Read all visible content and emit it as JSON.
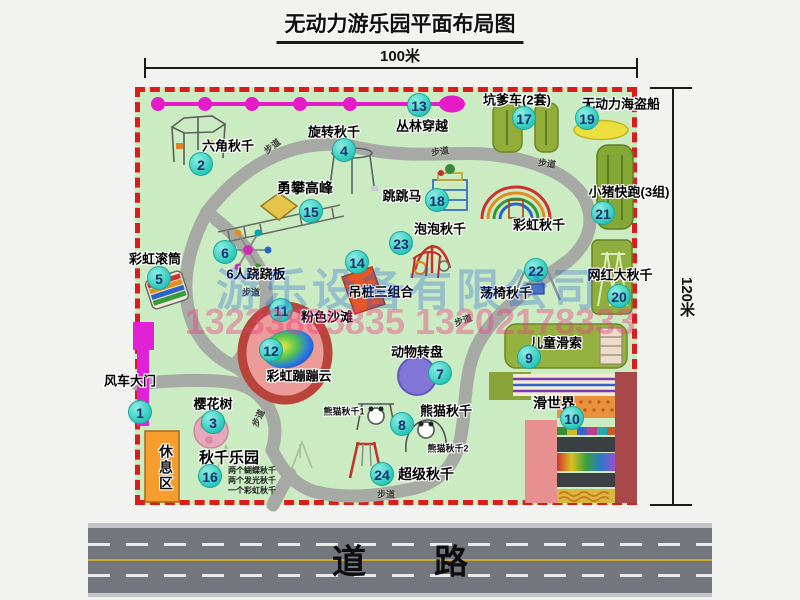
{
  "page": {
    "title": "无动力游乐园平面布局图",
    "top_dim": "100米",
    "right_dim": "120米"
  },
  "road": {
    "label": "道　　路"
  },
  "watermarks": {
    "company": "游乐设备有限公司",
    "phone": "13233805835 13202178333"
  },
  "colors": {
    "map_green": "#cbecc3",
    "border_red": "#dc1c1c",
    "badge_teal": "#2cc8bb",
    "zipline_magenta": "#e51ac8",
    "road_gray": "#73767d",
    "gate_magenta": "#e021d6",
    "rest_orange": "#f59d2e"
  },
  "map": {
    "rest_area_label": "休息区",
    "walkway_label": "步道",
    "walkways": [
      {
        "x": 272,
        "y": 146,
        "r": -38
      },
      {
        "x": 440,
        "y": 151,
        "r": -8
      },
      {
        "x": 547,
        "y": 163,
        "r": 8
      },
      {
        "x": 251,
        "y": 292,
        "r": 0
      },
      {
        "x": 258,
        "y": 418,
        "r": -65
      },
      {
        "x": 386,
        "y": 494,
        "r": 0
      },
      {
        "x": 463,
        "y": 320,
        "r": -20
      }
    ],
    "attractions": [
      {
        "num": 1,
        "label": "风车大门",
        "badge": [
          140,
          412
        ],
        "label_pos": [
          130,
          380
        ]
      },
      {
        "num": 2,
        "label": "六角秋千",
        "badge": [
          201,
          164
        ],
        "label_pos": [
          228,
          145
        ]
      },
      {
        "num": 3,
        "label": "樱花树",
        "badge": [
          213,
          422
        ],
        "label_pos": [
          213,
          403
        ]
      },
      {
        "num": 4,
        "label": "旋转秋千",
        "badge": [
          344,
          150
        ],
        "label_pos": [
          334,
          131
        ]
      },
      {
        "num": 5,
        "label": "彩虹滚筒",
        "badge": [
          159,
          278
        ],
        "label_pos": [
          155,
          258
        ]
      },
      {
        "num": 6,
        "label": "6人跷跷板",
        "badge": [
          225,
          252
        ],
        "label_pos": [
          256,
          273
        ]
      },
      {
        "num": 7,
        "label": "动物转盘",
        "badge": [
          440,
          373
        ],
        "label_pos": [
          417,
          351
        ]
      },
      {
        "num": 8,
        "label": "熊猫秋千",
        "badge": [
          402,
          424
        ],
        "label_pos": [
          446,
          410
        ]
      },
      {
        "num": 9,
        "label": "儿童滑索",
        "badge": [
          529,
          357
        ],
        "label_pos": [
          556,
          342
        ]
      },
      {
        "num": 10,
        "label": "滑世界",
        "badge": [
          572,
          418
        ],
        "label_pos": [
          554,
          403
        ],
        "fs": 14
      },
      {
        "num": 11,
        "label": "粉色沙滩",
        "badge": [
          281,
          310
        ],
        "label_pos": [
          327,
          316
        ]
      },
      {
        "num": 12,
        "label": "彩虹蹦蹦云",
        "badge": [
          271,
          350
        ],
        "label_pos": [
          299,
          375
        ]
      },
      {
        "num": 13,
        "label": "丛林穿越",
        "badge": [
          419,
          105
        ],
        "label_pos": [
          422,
          125
        ]
      },
      {
        "num": 14,
        "label": "吊桩三组合",
        "badge": [
          357,
          262
        ],
        "label_pos": [
          381,
          291
        ]
      },
      {
        "num": 15,
        "label": "勇攀高峰",
        "badge": [
          311,
          211
        ],
        "label_pos": [
          305,
          188
        ],
        "fs": 14
      },
      {
        "num": 16,
        "label": "秋千乐园",
        "badge": [
          210,
          476
        ],
        "label_pos": [
          229,
          457
        ],
        "fs": 15,
        "notes": [
          "两个蝴蝶秋千",
          "两个发光秋千",
          "一个彩虹秋千"
        ],
        "notes_pos": [
          228,
          466
        ]
      },
      {
        "num": 17,
        "label": "坑爹车(2套)",
        "badge": [
          524,
          118
        ],
        "label_pos": [
          517,
          99
        ]
      },
      {
        "num": 18,
        "label": "跳跳马",
        "badge": [
          437,
          200
        ],
        "label_pos": [
          402,
          195
        ]
      },
      {
        "num": 19,
        "label": "无动力海盗船",
        "badge": [
          587,
          118
        ],
        "label_pos": [
          621,
          103
        ]
      },
      {
        "num": 20,
        "label": "网红大秋千",
        "badge": [
          619,
          296
        ],
        "label_pos": [
          620,
          274
        ]
      },
      {
        "num": 21,
        "label": "小猪快跑(3组)",
        "badge": [
          603,
          213
        ],
        "label_pos": [
          629,
          191
        ]
      },
      {
        "num": 22,
        "label": "荡椅秋千",
        "badge": [
          536,
          270
        ],
        "label_pos": [
          506,
          292
        ]
      },
      {
        "num": 23,
        "label": "泡泡秋千",
        "badge": [
          401,
          243
        ],
        "label_pos": [
          440,
          228
        ]
      },
      {
        "num": 24,
        "label": "超级秋千",
        "badge": [
          382,
          474
        ],
        "label_pos": [
          426,
          474
        ],
        "fs": 14
      }
    ],
    "extra_labels": [
      {
        "label": "彩虹秋千",
        "pos": [
          539,
          224
        ],
        "small": false
      },
      {
        "label": "熊猫秋千1",
        "pos": [
          344,
          411
        ],
        "small": true
      },
      {
        "label": "熊猫秋千2",
        "pos": [
          448,
          448
        ],
        "small": true
      }
    ]
  }
}
